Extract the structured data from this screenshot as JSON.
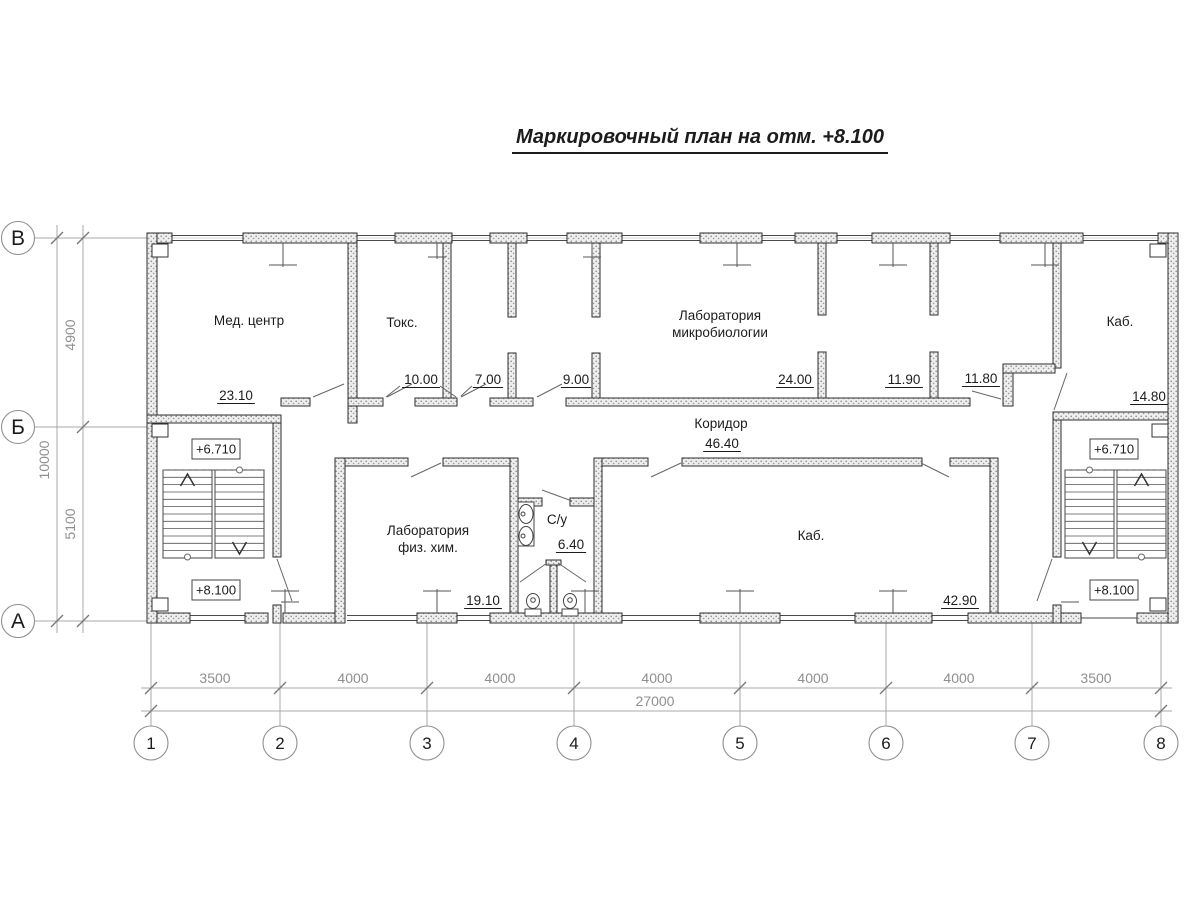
{
  "title": {
    "text": "Маркировочный план на отм. +8.100"
  },
  "colors": {
    "ink": "#1c1c1c",
    "wall_stroke": "#2e2e2e",
    "thin_line": "#4a4a4a",
    "dim_gray": "#8f8f8f",
    "grid_gray": "#a8a8a8",
    "background": "#ffffff"
  },
  "axes": {
    "rows": [
      {
        "label": "В",
        "y": 238
      },
      {
        "label": "Б",
        "y": 427
      },
      {
        "label": "А",
        "y": 621
      }
    ],
    "cols": [
      {
        "label": "1",
        "x": 151
      },
      {
        "label": "2",
        "x": 280
      },
      {
        "label": "3",
        "x": 427
      },
      {
        "label": "4",
        "x": 574
      },
      {
        "label": "5",
        "x": 740
      },
      {
        "label": "6",
        "x": 886
      },
      {
        "label": "7",
        "x": 1032
      },
      {
        "label": "8",
        "x": 1161
      }
    ]
  },
  "dimensions": {
    "bottom_segments": [
      {
        "text": "3500",
        "x": 215
      },
      {
        "text": "4000",
        "x": 353
      },
      {
        "text": "4000",
        "x": 500
      },
      {
        "text": "4000",
        "x": 657
      },
      {
        "text": "4000",
        "x": 813
      },
      {
        "text": "4000",
        "x": 959
      },
      {
        "text": "3500",
        "x": 1096
      }
    ],
    "bottom_total": {
      "text": "27000",
      "x": 655
    },
    "left_segments": [
      {
        "text": "4900",
        "y": 335
      },
      {
        "text": "5100",
        "y": 524
      }
    ],
    "left_total": {
      "text": "10000",
      "y": 460
    }
  },
  "rooms": [
    {
      "name": "Мед. центр",
      "nx": 249,
      "ny": 325,
      "area": "23.10",
      "ax": 236,
      "ay": 400
    },
    {
      "name": "Токс.",
      "nx": 402,
      "ny": 327,
      "area": "10.00",
      "ax": 421,
      "ay": 384
    },
    {
      "area": "7.00",
      "ax": 488,
      "ay": 384
    },
    {
      "area": "9.00",
      "ax": 576,
      "ay": 384
    },
    {
      "name": "Лаборатория",
      "name2": "микробиологии",
      "nx": 720,
      "ny": 320,
      "area": "24.00",
      "ax": 795,
      "ay": 384
    },
    {
      "area": "11.90",
      "ax": 904,
      "ay": 384
    },
    {
      "area": "11.80",
      "ax": 981,
      "ay": 383
    },
    {
      "name": "Каб.",
      "nx": 1120,
      "ny": 326,
      "area": "14.80",
      "ax": 1149,
      "ay": 401
    },
    {
      "name": "Коридор",
      "nx": 721,
      "ny": 428,
      "area": "46.40",
      "ax": 722,
      "ay": 448
    },
    {
      "name": "Лаборатория",
      "name2": "физ. хим.",
      "nx": 428,
      "ny": 535,
      "area": "19.10",
      "ax": 483,
      "ay": 605
    },
    {
      "name": "С/у",
      "nx": 557,
      "ny": 524,
      "area": "6.40",
      "ax": 571,
      "ay": 549
    },
    {
      "name": "Каб.",
      "nx": 811,
      "ny": 540,
      "area": "42.90",
      "ax": 960,
      "ay": 605
    }
  ],
  "elevations": [
    {
      "text": "+6.710",
      "bx": 192,
      "by": 439
    },
    {
      "text": "+8.100",
      "bx": 192,
      "by": 580
    },
    {
      "text": "+6.710",
      "bx": 1090,
      "by": 439
    },
    {
      "text": "+8.100",
      "bx": 1090,
      "by": 580
    }
  ]
}
